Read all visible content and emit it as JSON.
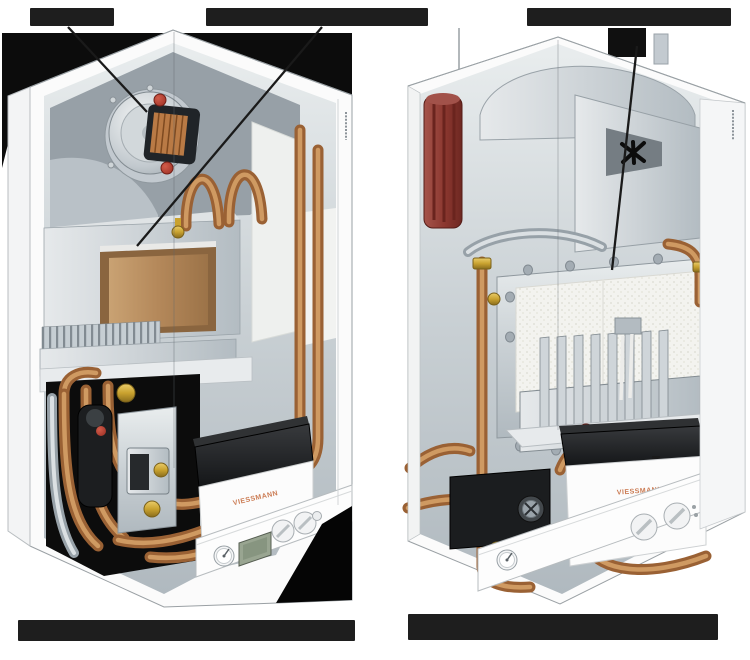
{
  "page": {
    "width": 750,
    "height": 660,
    "background": "#ffffff"
  },
  "diagram": {
    "description": "Cutaway technical illustrations of two Viessmann wall-hung gas condensing boilers shown side by side, with callout pointer lines; all label and caption text is redacted (solid black bars)",
    "boilers": [
      {
        "id": "left-boiler",
        "brand_text": "VIESSMANN",
        "side_marking_legible": false,
        "components": [
          "radial-fan-with-motor-coil",
          "red-caps",
          "combustion-chamber-tan-insulation",
          "burner-fin-row",
          "copper-u-pipes",
          "copper-riser-pipes",
          "gas-valve",
          "pump-body",
          "brass-fittings",
          "black-control-cover",
          "lcd-display",
          "pressure-gauge",
          "two-control-knobs",
          "small-button"
        ]
      },
      {
        "id": "right-boiler",
        "brand_text": "VIESSMANN",
        "side_marking_legible": false,
        "components": [
          "black-flue-outlet",
          "fan-impeller-cutout",
          "maroon-condensate-siphon",
          "silver-manifold",
          "combustion-chamber-white-insulation",
          "finned-heat-exchanger",
          "ignition-electrodes",
          "copper-riser-pipes",
          "black-pump-block",
          "red-cap",
          "brass-fittings",
          "black-control-cover",
          "pressure-gauge",
          "two-control-knobs",
          "small-button"
        ]
      }
    ],
    "callouts": {
      "top_labels": [
        {
          "id": "label-1",
          "text": "",
          "redacted": true,
          "points_to": "fan assembly of left boiler"
        },
        {
          "id": "label-2",
          "text": "",
          "redacted": true,
          "points_to": "combustion chamber of left boiler"
        },
        {
          "id": "label-3",
          "text": "",
          "redacted": true,
          "points_to": "heat-exchanger panel of right boiler"
        }
      ],
      "bottom_captions": [
        {
          "id": "caption-left",
          "text": "",
          "redacted": true
        },
        {
          "id": "caption-right",
          "text": "",
          "redacted": true
        }
      ]
    },
    "colors": {
      "redaction_bar": "#1e1e1e",
      "cabinet_white": "#fbfbfb",
      "interior_metal": "#c3cbd0",
      "copper_pipe": "#9a6134",
      "copper_highlight": "#cf9a62",
      "brass_fitting": "#c9a22f",
      "insulation_tan": "#b4885a",
      "foam_white": "#f2f3f1",
      "component_black": "#1b1d1f",
      "accent_red": "#b03a2e",
      "siphon_maroon": "#8b372f",
      "lcd_green": "#99a591",
      "brand_orange": "#cb7b53"
    }
  }
}
